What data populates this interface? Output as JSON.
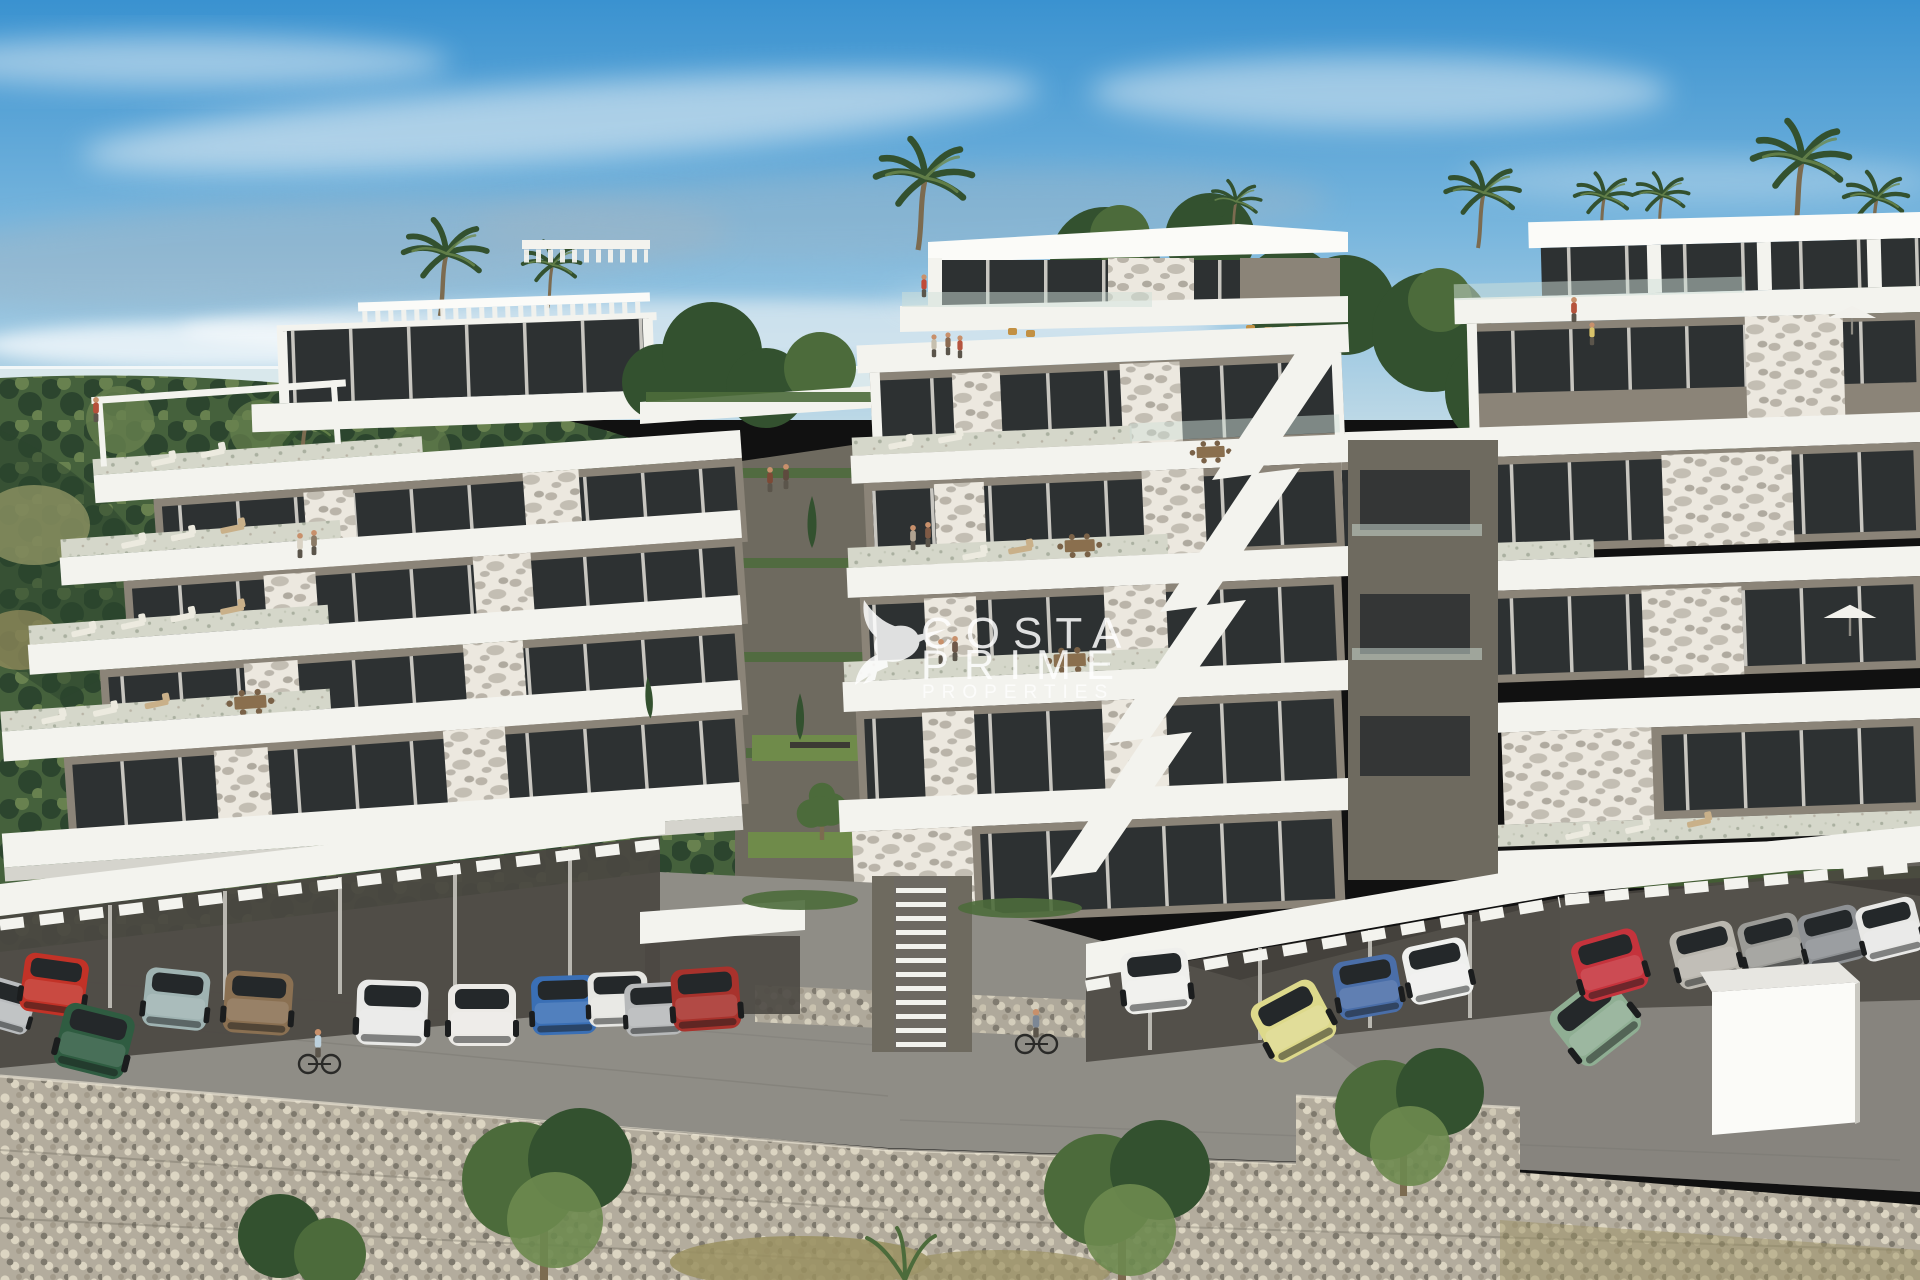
{
  "scene": {
    "type": "architectural-render-photo",
    "description": "Hillside terraced luxury apartment complex with parking level, palm trees, sea horizon and gabion retaining walls",
    "watermark": {
      "logo": "hummingbird-icon",
      "line1": "COSTA",
      "line2": "PRIME",
      "line3": "PROPERTIES",
      "color": "#ffffff"
    },
    "palette": {
      "sky_top": "#3a92d0",
      "sky_mid": "#79b6dd",
      "sky_low": "#bcd8e6",
      "sea": "#d9e8ec",
      "cloud_white": "#eef3f5",
      "cloud_gray": "#9fb6c6",
      "hill_dark": "#2c452e",
      "hill_mid": "#45613c",
      "hill_light": "#68814f",
      "hill_dry": "#8d9263",
      "white": "#f3f3ee",
      "white_bright": "#fbfbf8",
      "white_shade": "#d5d4cd",
      "taupe": "#8b8478",
      "taupe_dark": "#6e6a5f",
      "under_dark": "#4b4842",
      "window": "#2d3132",
      "mullion": "#e3e1da",
      "stone_base": "#ece8df",
      "stone_spot": "#a9a296",
      "stone_dark": "#716c60",
      "terrace": "#d5d7ca",
      "terrace_speck": "#aab0a0",
      "glass": "#cfe0d8",
      "pave": "#8f8d86",
      "pave_dark": "#77756f",
      "gravel": "#cfc9b8",
      "gabion": "#b3ac9d",
      "gabion_lt": "#dcd5c2",
      "gabion_dk": "#7e796d",
      "grass": "#6f8b4a",
      "grass_dry": "#9a9060",
      "foliage_dark": "#33512f",
      "foliage": "#4c6b3b",
      "foliage_lt": "#6d8a4f",
      "trunk": "#7c6b50",
      "skin": "#c8906b"
    },
    "cars": [
      {
        "name": "silver-car-left-edge",
        "color": "#b9bcbe"
      },
      {
        "name": "red-sports-car",
        "color": "#c23227"
      },
      {
        "name": "green-fastback",
        "color": "#2f5c41"
      },
      {
        "name": "teal-convertible",
        "color": "#9fb3b2"
      },
      {
        "name": "bronze-suv",
        "color": "#8a7052"
      },
      {
        "name": "white-suv",
        "color": "#e9e9e7"
      },
      {
        "name": "white-sedan",
        "color": "#eceae6"
      },
      {
        "name": "blue-sedan",
        "color": "#3a6fb5"
      },
      {
        "name": "white-compact",
        "color": "#e6e6e2"
      },
      {
        "name": "silver-hatchback",
        "color": "#b7b9ba"
      },
      {
        "name": "red-mercedes",
        "color": "#a8322c"
      },
      {
        "name": "white-mercedes",
        "color": "#efefec"
      },
      {
        "name": "yellow-golf",
        "color": "#ddd98b"
      },
      {
        "name": "blue-compact",
        "color": "#4a6ea8"
      },
      {
        "name": "white-coupe",
        "color": "#eff0ee"
      },
      {
        "name": "green-sedan",
        "color": "#8fae93"
      },
      {
        "name": "red-audi-tt",
        "color": "#c5333c"
      },
      {
        "name": "silver-sedan",
        "color": "#b9b6ae"
      },
      {
        "name": "gray-sedan",
        "color": "#9b9b97"
      },
      {
        "name": "gray-porsche",
        "color": "#8e9194"
      },
      {
        "name": "white-car-right",
        "color": "#e8e8e6"
      }
    ],
    "figures": {
      "cyclist_left_shirt": "#bcd0dc",
      "cyclist_center_shirt": "#7c8795",
      "residents": "people on terraces and balconies"
    }
  }
}
